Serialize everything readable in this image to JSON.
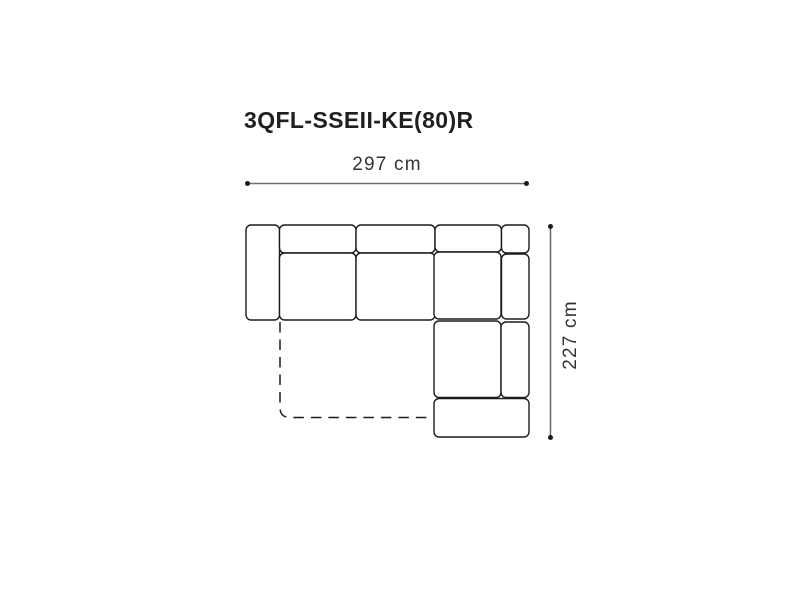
{
  "diagram": {
    "title": "3QFL-SSEII-KE(80)R",
    "width_dimension": {
      "label": "297 cm",
      "value_cm": 297
    },
    "height_dimension": {
      "label": "227 cm",
      "value_cm": 227
    },
    "sofa": {
      "type": "corner-sofa-top-view",
      "description": "L-shaped sectional sofa seen from above: left armrest, three backrest segments, two seat cushions, right-hand chaise with corner seat, right armrest and front rail, plus dashed outline of fold-out bed extension",
      "parts": [
        "left-armrest",
        "backrest-segment-1",
        "backrest-segment-2",
        "backrest-segment-3",
        "right-armrest-top",
        "seat-cushion-1",
        "seat-cushion-2",
        "corner-seat-cushion",
        "right-armrest-upper",
        "chaise-seat-cushion",
        "right-armrest-lower",
        "chaise-front-rail",
        "bed-extension-dashed-outline"
      ]
    },
    "colors": {
      "background": "#ffffff",
      "outline": "#1c1c1c",
      "dimension_line": "#707070",
      "dimension_dot": "#1a1a1a",
      "title_text": "#1f1f1f",
      "label_text": "#333333"
    }
  }
}
